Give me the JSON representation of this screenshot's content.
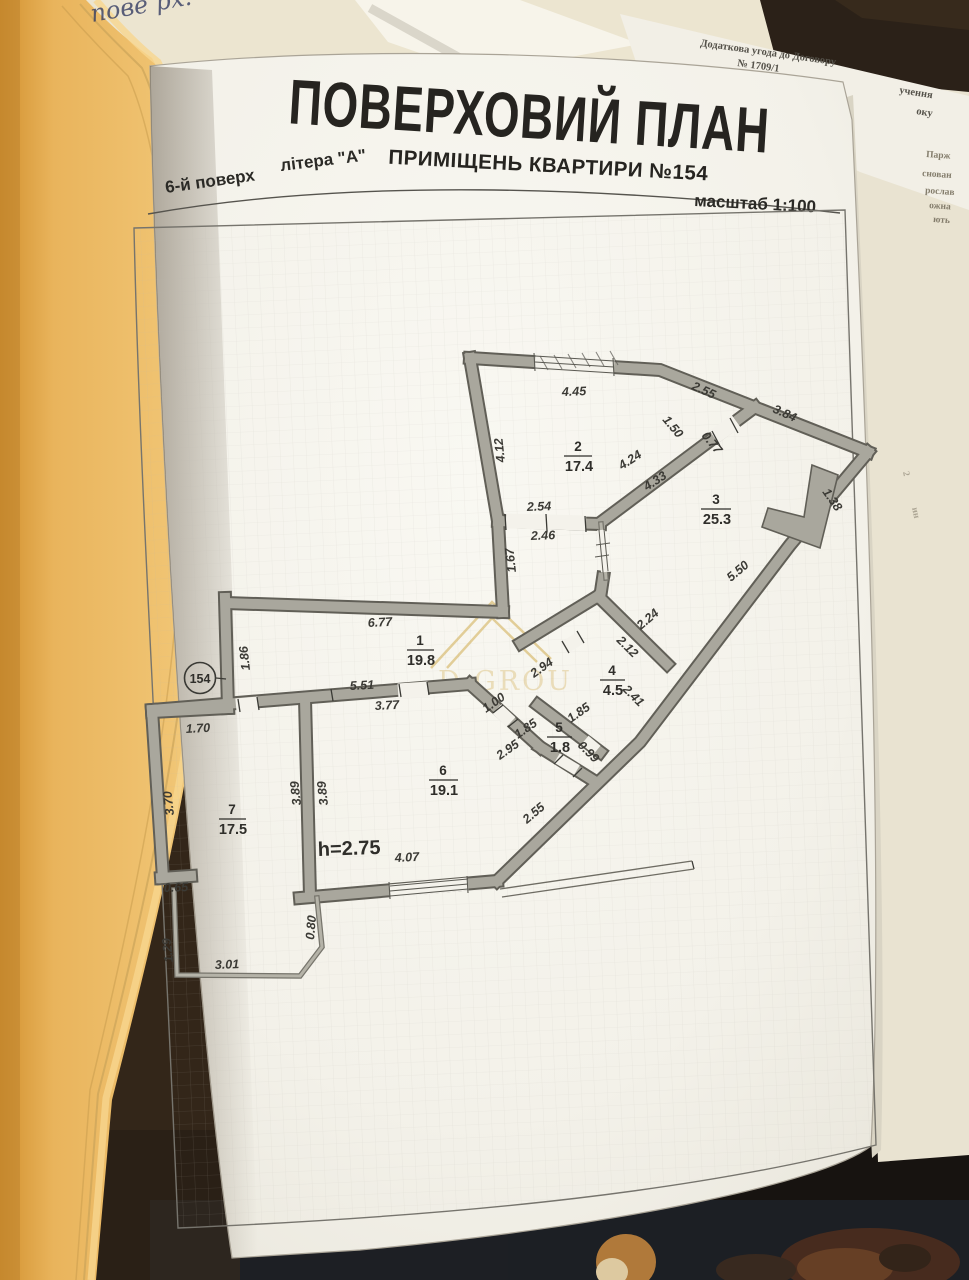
{
  "header": {
    "title": "ПОВЕРХОВИЙ ПЛАН",
    "subtitle": "ПРИМІЩЕНЬ  КВАРТИРИ №154",
    "floor_label": "6-й поверх",
    "letter_label": "літера \"А\"",
    "scale_label": "масштаб 1:100"
  },
  "background_documents": {
    "handwriting_fragment": "пове рх.",
    "top_document": {
      "line1_left": "Додаткова угода до Договору",
      "line1_right": "учення",
      "line2": "№ 1709/1",
      "line2_right": "оку"
    },
    "right_edge_fragments": [
      "Парж",
      "снован",
      "рослав",
      "ожна",
      "ють"
    ],
    "right_tiny_fragments": [
      "2",
      "ин"
    ]
  },
  "plan": {
    "apartment_number_badge": "154",
    "ceiling_height": "h=2.75",
    "rooms": [
      {
        "num": "1",
        "area": "19.8"
      },
      {
        "num": "2",
        "area": "17.4"
      },
      {
        "num": "3",
        "area": "25.3"
      },
      {
        "num": "4",
        "area": "4.5"
      },
      {
        "num": "5",
        "area": "1.8"
      },
      {
        "num": "6",
        "area": "19.1"
      },
      {
        "num": "7",
        "area": "17.5"
      }
    ],
    "dimensions": {
      "d445": "4.45",
      "d150": "1.50",
      "d255": "2.55",
      "d077": "0.77",
      "d384": "3.84",
      "d412": "4.12",
      "d424": "4.24",
      "d433": "4.33",
      "d138": "1.38",
      "d550": "5.50",
      "d254": "2.54",
      "d246": "2.46",
      "d167": "1.67",
      "d677": "6.77",
      "d186": "1.86",
      "d224": "2.24",
      "d212": "2.12",
      "d294": "2.94",
      "d241": "2.41",
      "d100": "1.00",
      "d185a": "1.85",
      "d185b": "1.85",
      "d295": "2.95",
      "d099": "0.99",
      "d551": "5.51",
      "d377": "3.77",
      "d389a": "3.89",
      "d389b": "3.89",
      "d170": "1.70",
      "d370": "3.70",
      "d065": "0.65",
      "d129": "1.29",
      "d080": "0.80",
      "d301": "3.01",
      "d407": "4.07",
      "d255b": "2.55"
    },
    "watermark_text": "D GROU"
  },
  "colors": {
    "page": "#f5f3ec",
    "book_cover": "#e9b45c",
    "walls_gray": "#a9a79d",
    "watermark_gold": "#cfa94e",
    "ink": "#2e2c28"
  }
}
